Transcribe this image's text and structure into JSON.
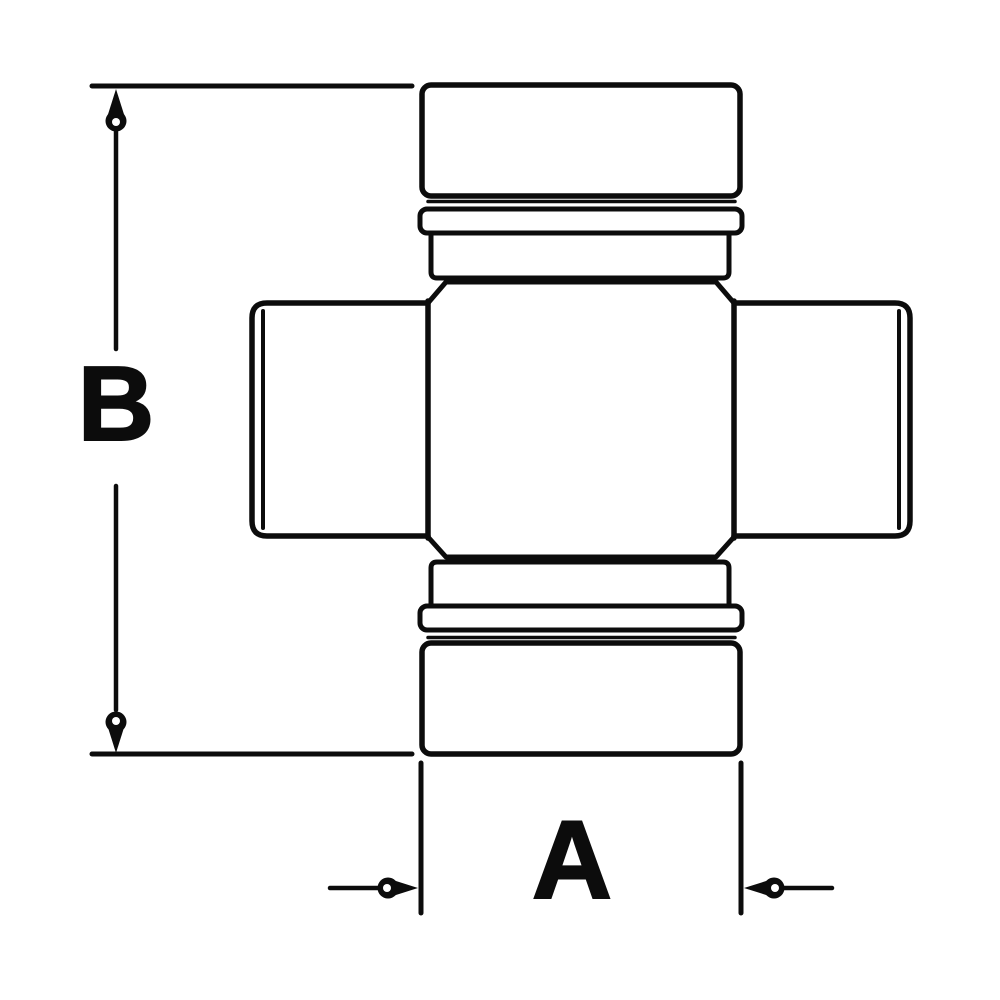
{
  "figure": {
    "title": "Universal joint cross with bearing caps - dimensioned technical drawing",
    "background_color": "#ffffff",
    "line_color": "#0c0c0c"
  },
  "dimensions": {
    "vertical": {
      "label": "B"
    },
    "horizontal": {
      "label": "A"
    }
  }
}
